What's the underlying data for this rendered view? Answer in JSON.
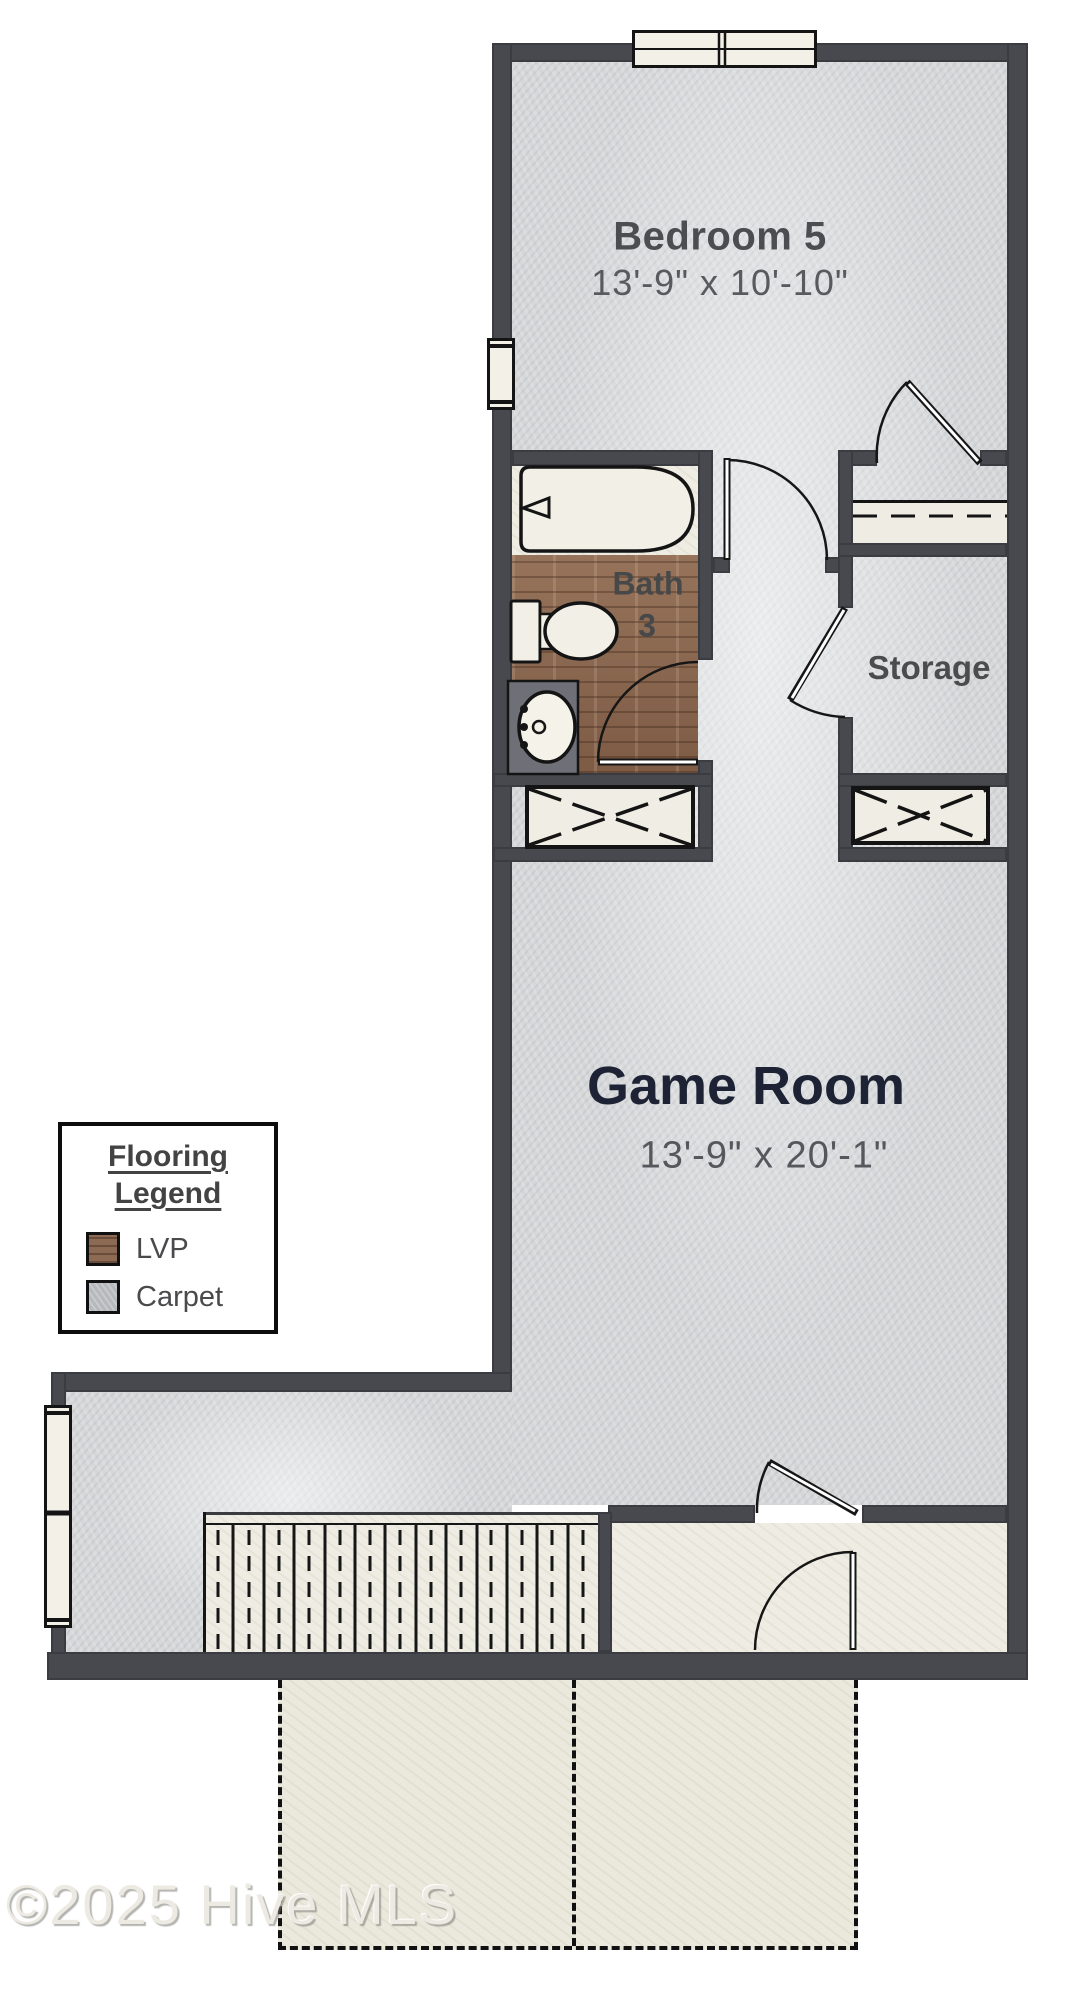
{
  "plan": {
    "type": "residential-floor-plan",
    "rooms": [
      {
        "name": "Bedroom 5",
        "dimensions": "13'-9\" x 10'-10\"",
        "flooring": "Carpet"
      },
      {
        "name": "Bath 3",
        "label_lines": [
          "Bath",
          "3"
        ],
        "flooring": "LVP"
      },
      {
        "name": "Storage",
        "flooring": "Carpet"
      },
      {
        "name": "Game Room",
        "dimensions": "13'-9\" x 20'-1\"",
        "flooring": "Carpet"
      }
    ],
    "legend": {
      "title_lines": [
        "Flooring",
        "Legend"
      ],
      "items": [
        {
          "label": "LVP",
          "color": "#8d6a53"
        },
        {
          "label": "Carpet",
          "color": "#b5b8bc"
        }
      ]
    },
    "watermark": "©2025 Hive MLS",
    "colors": {
      "wall": "#47494f",
      "carpet": "#d5d7d9",
      "lvp": "#8d6a53",
      "cream": "#efede3",
      "line": "#161616",
      "game_room_title": "#1d2335",
      "room_label": "#4b4c4e"
    }
  }
}
